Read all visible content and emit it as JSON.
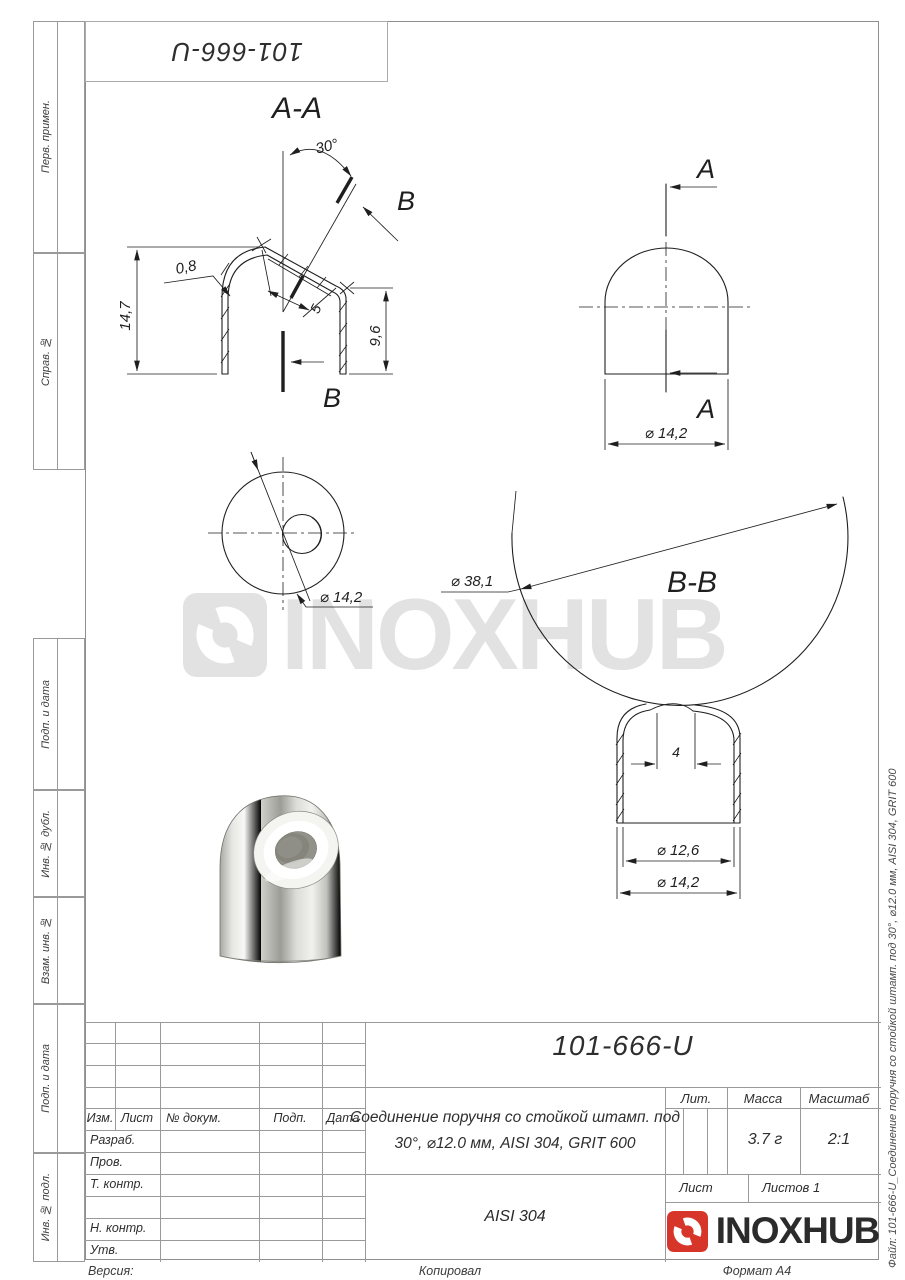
{
  "sheet": {
    "stamp_top": "101-666-U"
  },
  "margin": [
    "Перв. примен.",
    "Справ. №",
    "Подп. и дата",
    "Инв. № дубл.",
    "Взам. инв. №",
    "Подп. и дата",
    "Инв. № подл."
  ],
  "watermark": {
    "brand": "INOXHUB"
  },
  "drawing": {
    "labels": {
      "section_aa": "A-A",
      "section_bb": "B-B",
      "a": "A",
      "b": "B"
    },
    "dims": {
      "angle": "30°",
      "thickness": "0,8",
      "height_total": "14,7",
      "cut_length": "5",
      "height_right": "9,6",
      "dia_cap": "⌀ 14,2",
      "dia_top": "⌀ 14,2",
      "dia_sphere": "⌀ 38,1",
      "hole_gap": "4",
      "dia_inner": "⌀ 12,6",
      "dia_outer": "⌀ 14,2"
    }
  },
  "title_block": {
    "doc_number": "101-666-U",
    "title_line1": "Соединение поручня со стойкой штамп. под",
    "title_line2": "30°, ⌀12.0 мм, AISI 304, GRIT 600",
    "material": "AISI 304",
    "lit_label": "Лит.",
    "mass_label": "Масса",
    "mass_value": "3.7 г",
    "scale_label": "Масштаб",
    "scale_value": "2:1",
    "sheet_label": "Лист",
    "sheets_label": "Листов 1",
    "cols": {
      "izm": "Изм.",
      "list": "Лист",
      "doc": "№ докум.",
      "podp": "Подп.",
      "date": "Дата"
    },
    "rows": {
      "razrab": "Разраб.",
      "prov": "Пров.",
      "tkontr": "Т. контр.",
      "nkontr": "Н. контр.",
      "utv": "Утв."
    },
    "brand": "INOXHUB"
  },
  "footer": {
    "version": "Версия:",
    "copied": "Копировал",
    "format": "Формат А4"
  },
  "side_note": "Файл: 101-666-U_Соединение поручня со стойкой штамп. под 30°, ⌀12.0 мм, AISI 304, GRIT 600",
  "colors": {
    "brand_red": "#d7352a",
    "line_dark": "#1f1f1f",
    "table_line": "#9a9a9a",
    "watermark": "#e2e2e2"
  }
}
